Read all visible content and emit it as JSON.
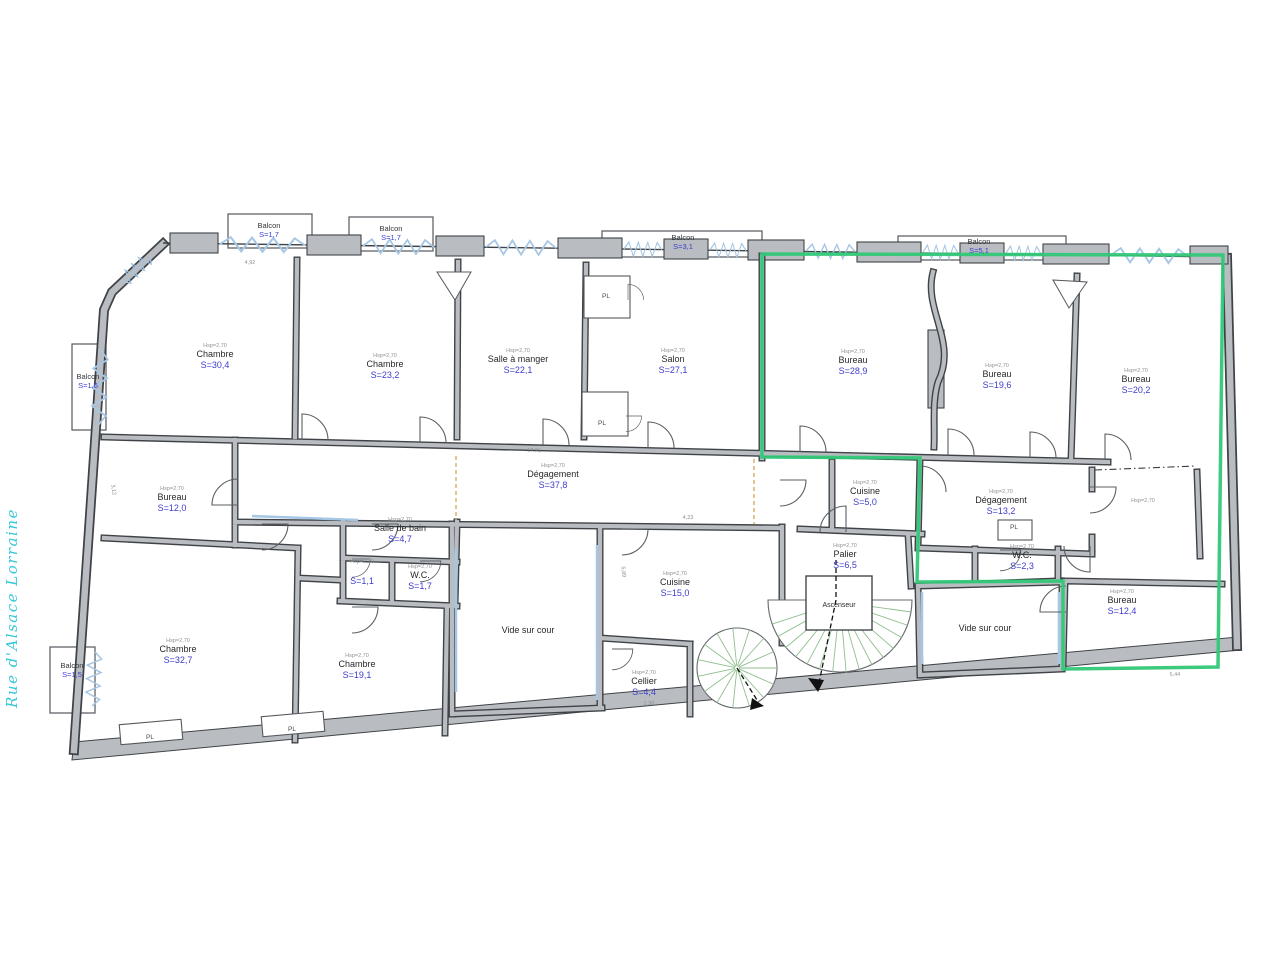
{
  "street": {
    "label": "Rue d'Alsace Lorraine"
  },
  "ceiling_note": "Hsp=2,70",
  "colors": {
    "wall_gray": "#b9bdc1",
    "wall_dark": "#3f4347",
    "win_blue": "#a5c6e4",
    "green": "#31c877",
    "stair_green": "#8fbf8f",
    "cyan": "#38c8d8",
    "tan": "#d9b36b",
    "area_blue": "#3d3dcb"
  },
  "rooms": [
    {
      "name": "Chambre",
      "area": "S=30,4",
      "x": 215,
      "y": 357
    },
    {
      "name": "Chambre",
      "area": "S=23,2",
      "x": 385,
      "y": 367
    },
    {
      "name": "Salle à manger",
      "area": "S=22,1",
      "x": 518,
      "y": 362
    },
    {
      "name": "Salon",
      "area": "S=27,1",
      "x": 673,
      "y": 362
    },
    {
      "name": "Bureau",
      "area": "S=28,9",
      "x": 853,
      "y": 363
    },
    {
      "name": "Bureau",
      "area": "S=19,6",
      "x": 997,
      "y": 377
    },
    {
      "name": "Bureau",
      "area": "S=20,2",
      "x": 1136,
      "y": 382
    },
    {
      "name": "Bureau",
      "area": "S=12,0",
      "x": 172,
      "y": 500
    },
    {
      "name": "Dégagement",
      "area": "S=37,8",
      "x": 553,
      "y": 477
    },
    {
      "name": "Salle de bain",
      "area": "S=4,7",
      "x": 400,
      "y": 531
    },
    {
      "name": "",
      "area": "S=1,1",
      "x": 362,
      "y": 573
    },
    {
      "name": "W.C.",
      "area": "S=1,7",
      "x": 420,
      "y": 578
    },
    {
      "name": "Cuisine",
      "area": "S=5,0",
      "x": 865,
      "y": 494
    },
    {
      "name": "Dégagement",
      "area": "S=13,2",
      "x": 1001,
      "y": 503
    },
    {
      "name": "W.C.",
      "area": "S=2,3",
      "x": 1022,
      "y": 558
    },
    {
      "name": "Palier",
      "area": "S=6,5",
      "x": 845,
      "y": 557
    },
    {
      "name": "",
      "area": "",
      "x": 1143,
      "y": 512
    },
    {
      "name": "Chambre",
      "area": "S=32,7",
      "x": 178,
      "y": 652
    },
    {
      "name": "Chambre",
      "area": "S=19,1",
      "x": 357,
      "y": 667
    },
    {
      "name": "Cuisine",
      "area": "S=15,0",
      "x": 675,
      "y": 585
    },
    {
      "name": "Cellier",
      "area": "S=4,4",
      "x": 644,
      "y": 684
    },
    {
      "name": "Bureau",
      "area": "S=12,4",
      "x": 1122,
      "y": 603
    },
    {
      "name": "Vide sur cour",
      "area": "",
      "note": false,
      "x": 528,
      "y": 633
    },
    {
      "name": "Vide sur cour",
      "area": "",
      "note": false,
      "x": 985,
      "y": 631
    },
    {
      "name": "Ascenseur",
      "area": "",
      "note": false,
      "small": true,
      "x": 839,
      "y": 607
    }
  ],
  "balconies": [
    {
      "name": "Balcon",
      "area": "S=1,7",
      "x": 269,
      "y": 228
    },
    {
      "name": "Balcon",
      "area": "S=1,7",
      "x": 391,
      "y": 231
    },
    {
      "name": "Balcon",
      "area": "S=3,1",
      "x": 683,
      "y": 240
    },
    {
      "name": "Balcon",
      "area": "S=5,1",
      "x": 979,
      "y": 244
    },
    {
      "name": "Balcon",
      "area": "S=1,6",
      "x": 88,
      "y": 379
    },
    {
      "name": "Balcon",
      "area": "S=1,5",
      "x": 72,
      "y": 668
    }
  ],
  "closets": [
    {
      "label": "PL",
      "x": 606,
      "y": 298
    },
    {
      "label": "PL",
      "x": 602,
      "y": 425
    },
    {
      "label": "PL",
      "x": 1014,
      "y": 529
    },
    {
      "label": "PL",
      "x": 292,
      "y": 731
    },
    {
      "label": "PL",
      "x": 150,
      "y": 739
    }
  ],
  "dimensions": [
    {
      "text": "4,92",
      "x": 250,
      "y": 264,
      "r": 1
    },
    {
      "text": "17,71",
      "x": 534,
      "y": 452,
      "r": 1
    },
    {
      "text": "4,23",
      "x": 688,
      "y": 519,
      "r": 1
    },
    {
      "text": "5,89",
      "x": 622,
      "y": 572,
      "r": 85
    },
    {
      "text": "3,12",
      "x": 112,
      "y": 490,
      "r": 82
    },
    {
      "text": "2,30",
      "x": 649,
      "y": 705,
      "r": -3
    },
    {
      "text": "5,44",
      "x": 1175,
      "y": 676,
      "r": -2
    }
  ]
}
